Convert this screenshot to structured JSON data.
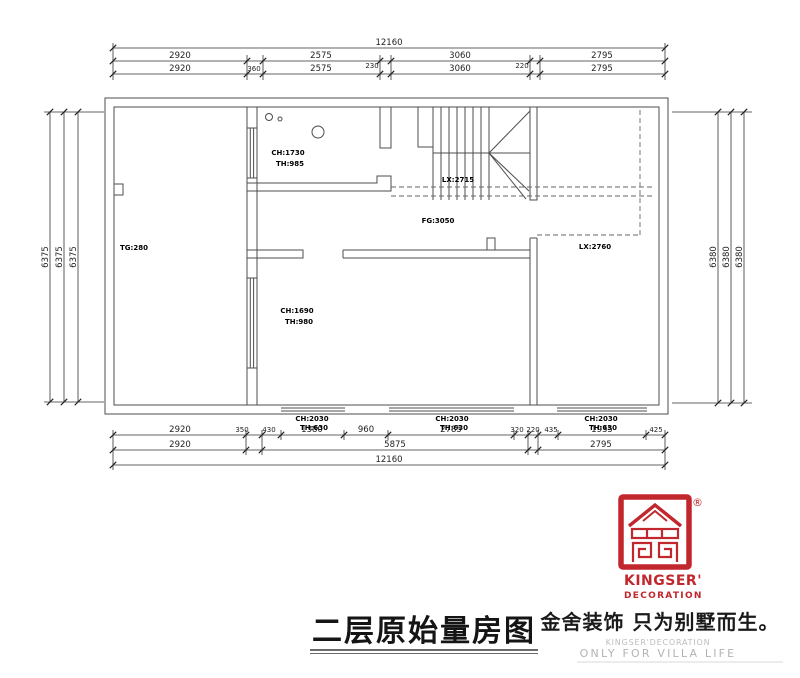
{
  "title": {
    "text": "二层原始量房图"
  },
  "brand": {
    "logo_line1": "KINGSER'",
    "logo_line2": "DECORATION",
    "registered_mark": "®",
    "slogan_cn": "金舍装饰 只为别墅而生。",
    "slogan_en_small": "KINGSER'DECORATION",
    "slogan_en": "ONLY FOR VILLA LIFE"
  },
  "dims": {
    "top_total": "12160",
    "top_row2": [
      "2920",
      "2575",
      "3060",
      "2795"
    ],
    "top_row2_small": [
      "230",
      "220"
    ],
    "top_row3": [
      "2920",
      "360",
      "2575",
      "3060",
      "2795"
    ],
    "bottom_row1": [
      "2920",
      "350",
      "430",
      "1380",
      "960",
      "2785",
      "320",
      "220",
      "435",
      "1935",
      "425"
    ],
    "bottom_row2": [
      "2920",
      "5875",
      "2795"
    ],
    "bottom_total": "12160",
    "left": [
      "6375",
      "6375",
      "6375"
    ],
    "right": [
      "6380",
      "6380",
      "6380"
    ]
  },
  "rooms": {
    "left_room": "TG:280",
    "top_room_ch": "CH:1730",
    "top_room_th": "TH:985",
    "stair_lx": "LX:2715",
    "hall_fg": "FG:3050",
    "void_lx": "LX:2760",
    "mid_room_ch": "CH:1690",
    "mid_room_th": "TH:980"
  },
  "windows": [
    {
      "ch": "CH:2030",
      "th": "TH:630"
    },
    {
      "ch": "CH:2030",
      "th": "TH:630"
    },
    {
      "ch": "CH:2030",
      "th": "TH:630"
    }
  ],
  "colors": {
    "plan_line": "#4d4d4d",
    "dim_line": "#333333",
    "brand_red": "#c1272d",
    "muted_gray": "#b5b5b5"
  }
}
